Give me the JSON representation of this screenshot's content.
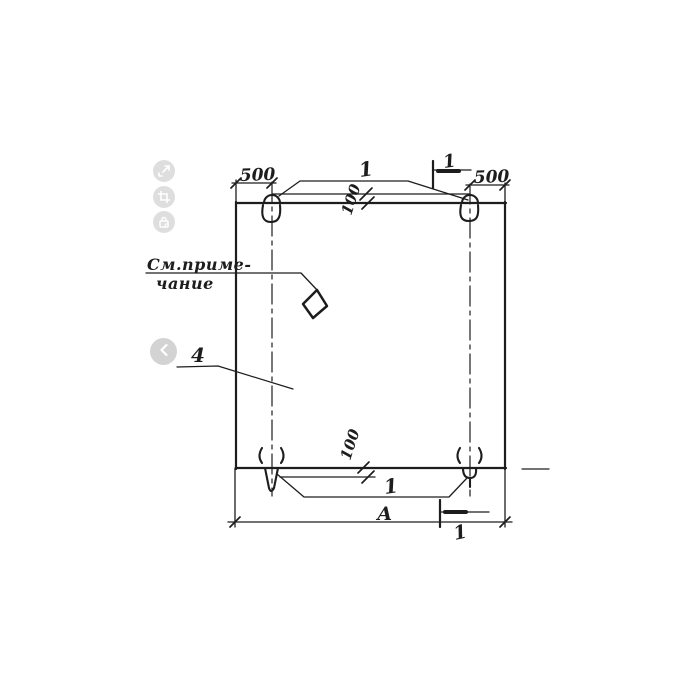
{
  "viewer": {
    "toolbar": [
      {
        "name": "expand",
        "icon": "expand-icon"
      },
      {
        "name": "crop",
        "icon": "crop-icon"
      },
      {
        "name": "lock",
        "icon": "lock-icon"
      }
    ],
    "nav": {
      "prev": "chevron-left-icon"
    }
  },
  "drawing": {
    "note": {
      "line1": "См.приме-",
      "line2": "чание"
    },
    "dims": {
      "left_edge_to_loop": "500",
      "right_edge_to_loop": "500",
      "top_loop_offset": "100",
      "bottom_loop_offset": "100",
      "overall_width": "А"
    },
    "callouts": {
      "top_loops": "1",
      "bottom_loops": "1",
      "panel_item": "4"
    },
    "section_marks": {
      "top": "1",
      "bottom": "1"
    },
    "colors": {
      "ink": "#1d1d1d",
      "ui_gray": "#d9d9d9"
    }
  }
}
